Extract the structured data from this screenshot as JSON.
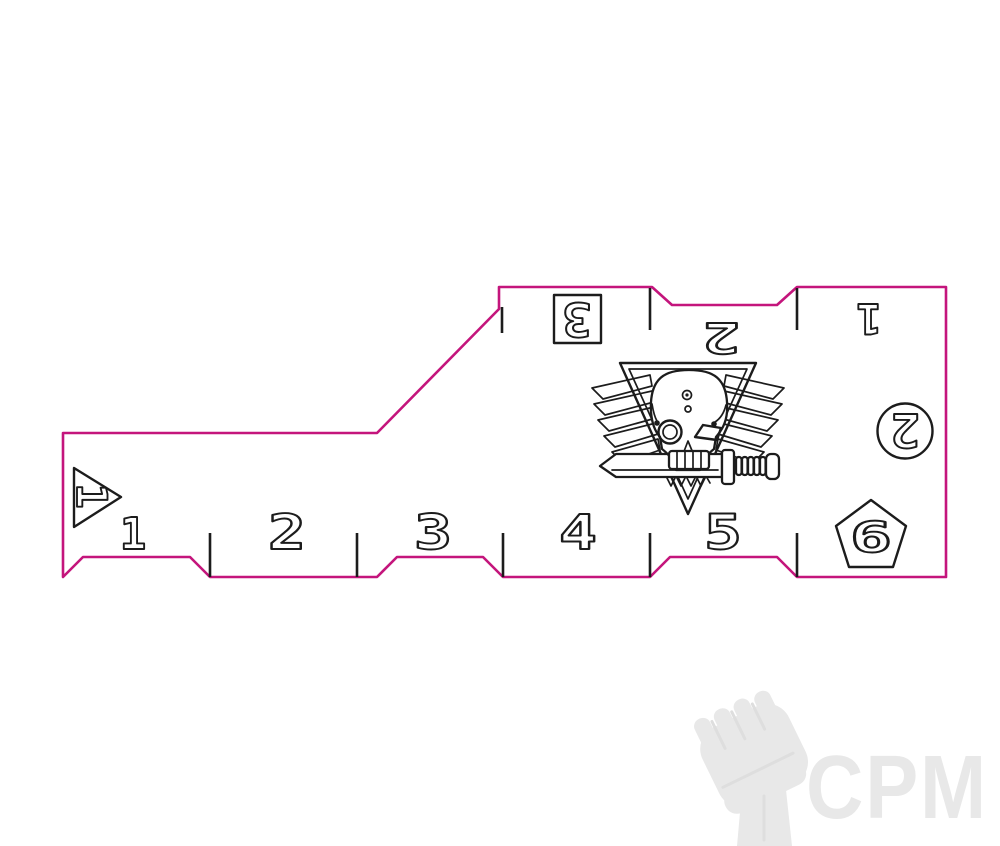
{
  "colors": {
    "background": "#ffffff",
    "cut_line": "#c4157c",
    "engrave_line": "#1c1c1c",
    "watermark": "#e8e8e8",
    "watermark_deep": "#dedede"
  },
  "top_scale": {
    "labels": [
      "3",
      "2",
      "1"
    ]
  },
  "bottom_scale": {
    "labels": [
      "1",
      "2",
      "3",
      "4",
      "5"
    ]
  },
  "markers": {
    "triangle_label": "1",
    "circle_label": "2",
    "pentagon_label": "6"
  },
  "watermark": {
    "text": "CPM"
  }
}
